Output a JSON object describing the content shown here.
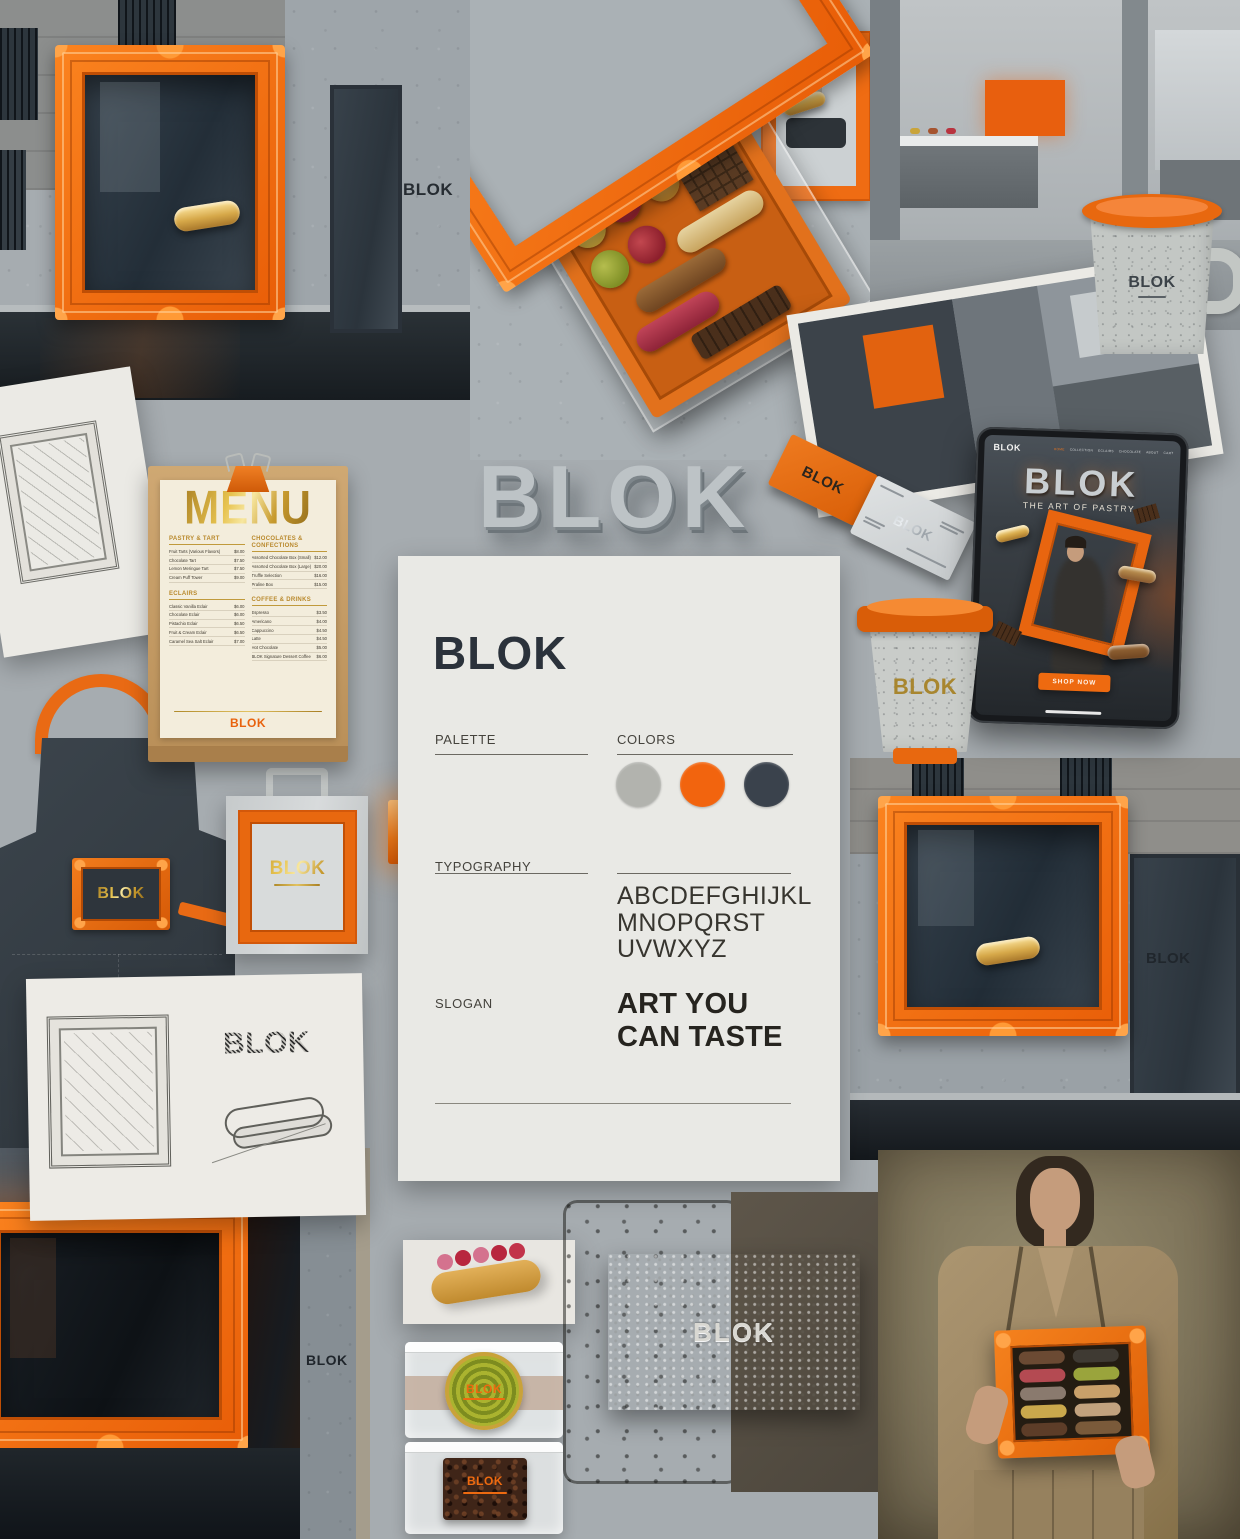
{
  "brand": {
    "name": "BLOK"
  },
  "signs": {
    "storefront_sign": "BLOK"
  },
  "hero_3d_logo": "BLOK",
  "menu_card": {
    "title": "MENU",
    "footer_logo": "BLOK",
    "sections": [
      {
        "name": "PASTRY & TART",
        "items": [
          {
            "name": "Fruit Tarts (Various Flavors)",
            "price": "$8.00"
          },
          {
            "name": "Chocolate Tart",
            "price": "$7.50"
          },
          {
            "name": "Lemon Meringue Tart",
            "price": "$7.50"
          },
          {
            "name": "Cream Puff Tower",
            "price": "$9.00"
          }
        ]
      },
      {
        "name": "CHOCOLATES & CONFECTIONS",
        "items": [
          {
            "name": "Assorted Chocolate Box (Small)",
            "price": "$12.00"
          },
          {
            "name": "Assorted Chocolate Box (Large)",
            "price": "$20.00"
          },
          {
            "name": "Truffle Selection",
            "price": "$16.00"
          },
          {
            "name": "Praline Box",
            "price": "$15.00"
          }
        ]
      },
      {
        "name": "ECLAIRS",
        "items": [
          {
            "name": "Classic Vanilla Eclair",
            "price": "$6.00"
          },
          {
            "name": "Chocolate Eclair",
            "price": "$6.00"
          },
          {
            "name": "Pistachio Eclair",
            "price": "$6.50"
          },
          {
            "name": "Fruit & Cream Eclair",
            "price": "$6.50"
          },
          {
            "name": "Caramel Sea Salt Eclair",
            "price": "$7.00"
          }
        ]
      },
      {
        "name": "COFFEE & DRINKS",
        "items": [
          {
            "name": "Espresso",
            "price": "$3.50"
          },
          {
            "name": "Americano",
            "price": "$4.00"
          },
          {
            "name": "Cappuccino",
            "price": "$4.50"
          },
          {
            "name": "Latte",
            "price": "$4.50"
          },
          {
            "name": "Hot Chocolate",
            "price": "$5.00"
          },
          {
            "name": "BLOK Signature Dessert Coffee",
            "price": "$6.00"
          }
        ]
      }
    ]
  },
  "brand_sheet": {
    "logo": "BLOK",
    "palette_label": "PALETTE",
    "colors_label": "COLORS",
    "typography_label": "TYPOGRAPHY",
    "slogan_label": "SLOGAN",
    "alphabet": [
      "ABCDEFGHIJKL",
      "MNOPQRST",
      "UVWXYZ"
    ],
    "slogan_lines": [
      "ART YOU",
      "CAN TASTE"
    ],
    "swatches": [
      "#b2b3ae",
      "#f2640e",
      "#3a424c"
    ]
  },
  "tablet": {
    "logo": "BLOK",
    "nav": [
      "HOME",
      "COLLECTION",
      "ECLAIRS",
      "CHOCOLATE",
      "ABOUT",
      "CART"
    ],
    "hero_title": "BLOK",
    "hero_subtitle": "THE ART OF PASTRY.",
    "cta_label": "SHOP NOW"
  },
  "business_cards": {
    "orange_logo": "BLOK",
    "white_logo": "BLOK"
  },
  "mug_logo": "BLOK",
  "cup_logo": "BLOK",
  "apron_patch_logo": "BLOK",
  "bag_logo": "BLOK",
  "sketch_logo": "BLOK",
  "embossed_logo": "BLOK",
  "packaging": {
    "spiral_label": "BLOK",
    "brownie_label": "BLOK"
  }
}
